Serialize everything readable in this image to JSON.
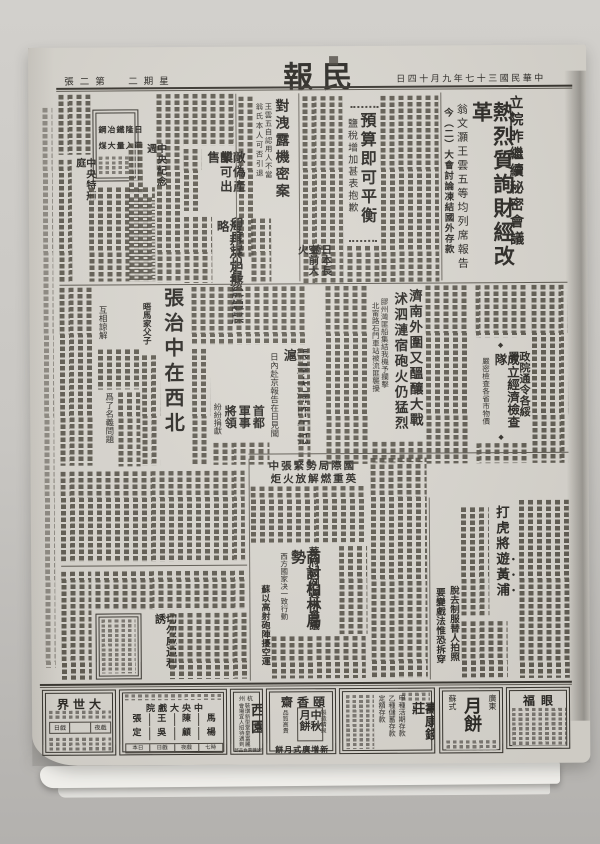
{
  "page": {
    "masthead": "民報",
    "edition": "第二張",
    "weekday": "星期二",
    "date": "中華民國三十七年九月十四日"
  },
  "ornaments": {
    "diamond": "◆"
  },
  "stories": {
    "lead": {
      "kicker": "立院昨繼續秘密會議",
      "headline": "熱烈質詢財經改革",
      "deck1": "翁文灝王雲五等均列席報告",
      "deck2": "今（二）大會討論凍結國外存款"
    },
    "budget": {
      "headline": "預算即可平衡",
      "deck": "鹽稅增加甚表抱歉"
    },
    "leak": {
      "headline": "對洩露機密案",
      "deck1": "王雲五自認用人不當",
      "deck2": "翁氏本人可否引退"
    },
    "enemy": {
      "line1": "敵偽產業",
      "line2": "卽可出售"
    },
    "india": {
      "headline": "印度提出最後通牒",
      "deck": "海邦决定抵抗侵略"
    },
    "memorial": {
      "headline": "中央紀念週"
    },
    "court": {
      "headline": "中央特刑庭"
    },
    "nagasaki": {
      "line1": "日本長崎",
      "line2": "空前大火"
    },
    "zhang": {
      "headline": "張治中在西北",
      "sub1": "晤馬家父子",
      "sub2": "互相諒解",
      "sub3": "爲了名義問題"
    },
    "zhangqun": {
      "headline": "張羣夫婦昨午抵滬",
      "deck": "日內赴京報告在日見聞"
    },
    "capital": {
      "seg1": "首都",
      "seg2": "軍事",
      "seg3": "將領",
      "deck": "紛紛捐獻"
    },
    "jinan": {
      "headline1": "濟南外圍又醞釀大戰",
      "headline2": "沭泗漣宿砲火仍猛烈",
      "deck1": "膠州灣匪船集結我機予攔擊",
      "deck2": "北甯路石門車站被流匪襲擾"
    },
    "econ": {
      "kicker": "政院通令各綏署",
      "headline": "成立經濟檢查隊",
      "deck": "嚴密檢查各省市物價"
    },
    "intl": {
      "line1": "國際局勢緊張中",
      "line2": "英重燃解放火炬"
    },
    "berlin": {
      "kicker": "華府破例週末會議",
      "headline": "商討柏林局勢",
      "deck": "西方國家决一致行動",
      "side": "蘇以高射砲陣擾空運"
    },
    "tiger": {
      "headline_a": "打虎將",
      "headline_b": "遊黃浦",
      "sub1": "脫去制服替人拍照",
      "sub2": "要變戲法惟恐拆穿"
    },
    "railway": {
      "headline": "切勿威迫利誘"
    }
  },
  "ads": {
    "steel": {
      "line1": "日隆鐵冶鋼",
      "line2": "購入量大煤"
    },
    "dashijie": {
      "name": "大世界",
      "label1": "日戲",
      "label2": "夜戲"
    },
    "central": {
      "name": "中央大戲院",
      "performers": [
        "張",
        "王",
        "陳",
        "馬",
        "定",
        "吳",
        "顧",
        "楊"
      ],
      "labels": [
        "本日",
        "日戲",
        "夜戲",
        "七時"
      ]
    },
    "xiyuan": {
      "city": "杭州",
      "name": "西園",
      "line1": "裝璜新型堂皇富麗",
      "line2": "會場宜人招待週到",
      "line3": "附設糖菓食品部"
    },
    "yixiang": {
      "name": "頤香齋",
      "right": "製造精良",
      "product": "中秋月餅",
      "left": "品質高貴",
      "bottom": "新增廣式月餅"
    },
    "shoukang": {
      "name": "壽康錢莊",
      "s1": "甲種活期存款",
      "s2": "乙種儲蓄存款",
      "s3": "定額存款"
    },
    "mooncake": {
      "right": "廣東",
      "name": "月餅",
      "left": "蘇式"
    },
    "yanfu": {
      "name": "眼福"
    }
  }
}
